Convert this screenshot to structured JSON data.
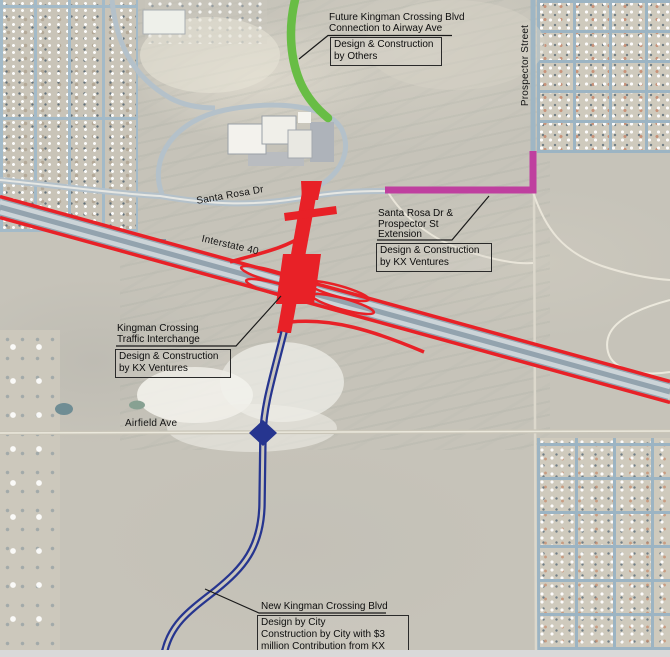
{
  "street_labels": {
    "prospector": "Prospector Street",
    "santa_rosa": "Santa Rosa Dr",
    "interstate": "Interstate 40",
    "airfield": "Airfield Ave"
  },
  "annotations": {
    "future_connection": {
      "title": "Future Kingman Crossing Blvd\nConnection to Airway Ave",
      "box": "Design & Construction\nby Others"
    },
    "extension": {
      "title": "Santa Rosa Dr &\nProspector St\nExtension",
      "box": "Design & Construction\nby KX Ventures"
    },
    "interchange": {
      "title": "Kingman Crossing\nTraffic Interchange",
      "box": "Design & Construction\nby KX Ventures"
    },
    "new_blvd": {
      "title": "New Kingman Crossing Blvd",
      "box": "Design by City\nConstruction by City with $3\nmillion Contribution from KX"
    }
  },
  "route_colors": {
    "interstate_red": "#e82127",
    "future_connection_green": "#68bd45",
    "extension_magenta": "#bf3f9f",
    "new_blvd_blue": "#26358f"
  }
}
